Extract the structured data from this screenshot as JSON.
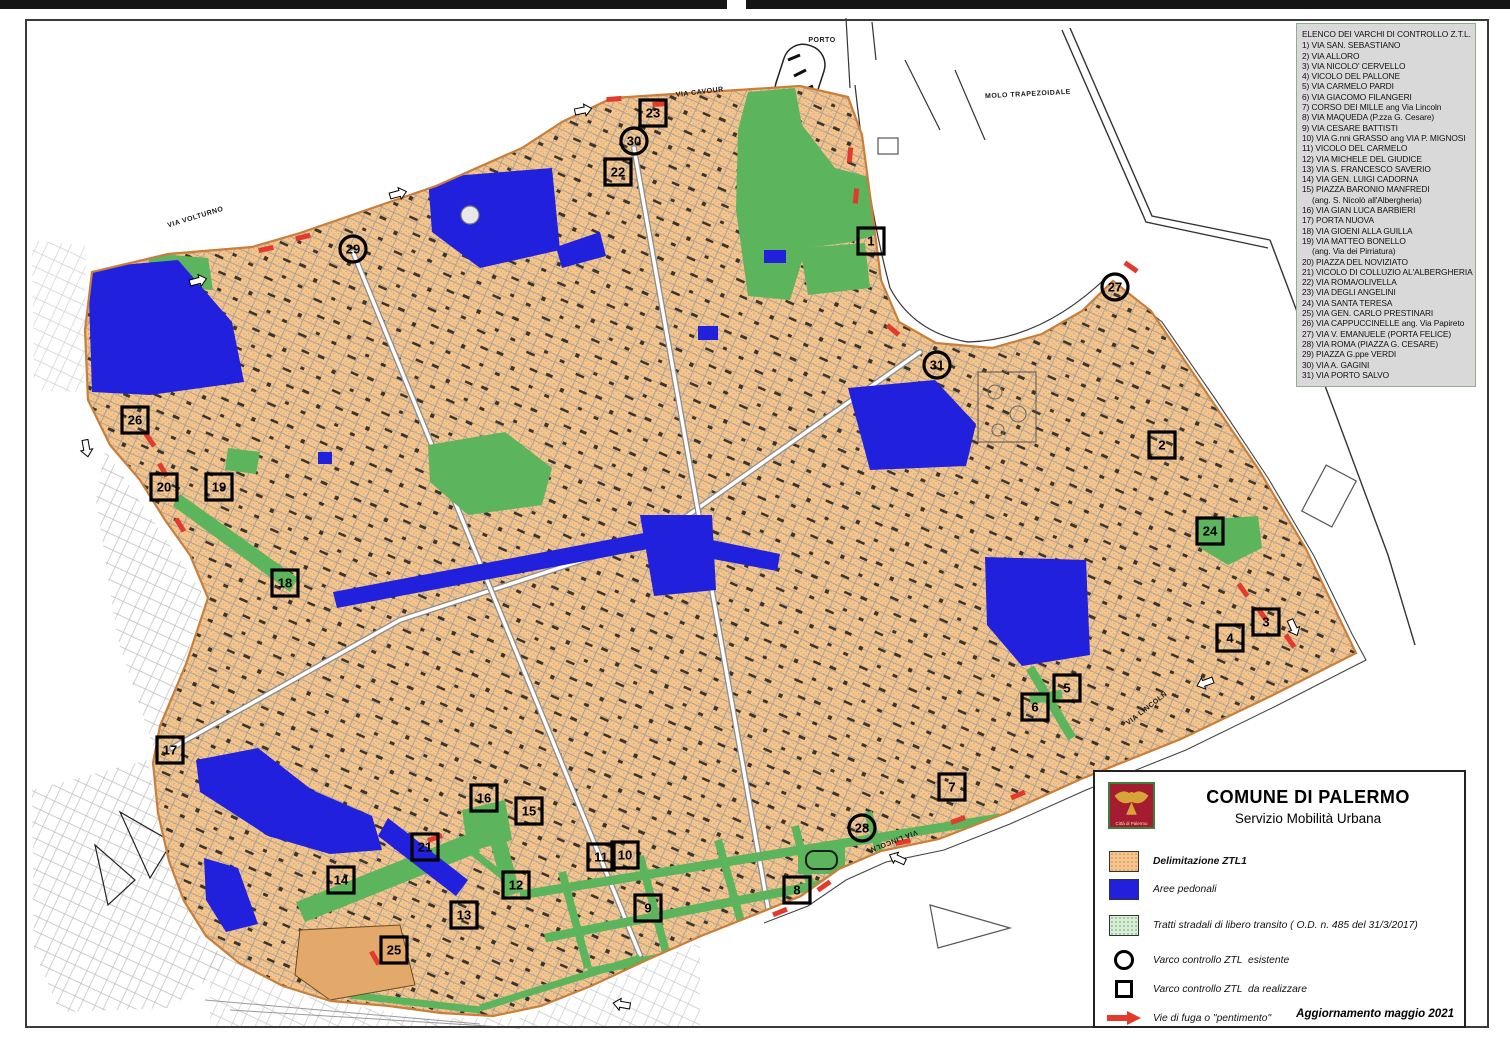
{
  "colors": {
    "ztl_tan": "#f3c58f",
    "pedonale_blue": "#2121dd",
    "transit_green": "#5cb45c",
    "legend_green": "#d8ecd8",
    "red": "#e23b2e",
    "boundary_orange": "#c87f3c",
    "elenco_bg": "#d9d9d9"
  },
  "elenco": {
    "title": "ELENCO DEI VARCHI DI CONTROLLO Z.T.L.",
    "lines": [
      {
        "t": "1) VIA SAN. SEBASTIANO"
      },
      {
        "t": "2) VIA ALLORO"
      },
      {
        "t": "3) VIA NICOLO' CERVELLO"
      },
      {
        "t": "4) VICOLO DEL PALLONE"
      },
      {
        "t": "5) VIA CARMELO PARDI"
      },
      {
        "t": "6) VIA GIACOMO FILANGERI"
      },
      {
        "t": "7) CORSO DEI MILLE ang Via Lincoln"
      },
      {
        "t": "8) VIA MAQUEDA (P.zza G. Cesare)"
      },
      {
        "t": "9) VIA CESARE BATTISTI"
      },
      {
        "t": "10) VIA G.nni GRASSO ang VIA P. MIGNOSI"
      },
      {
        "t": "11) VICOLO DEL CARMELO"
      },
      {
        "t": "12) VIA MICHELE DEL GIUDICE"
      },
      {
        "t": "13) VIA S. FRANCESCO SAVERIO"
      },
      {
        "t": "14) VIA GEN. LUIGI CADORNA"
      },
      {
        "t": "15) PIAZZA BARONIO MANFREDI"
      },
      {
        "t": "(ang. S. Nicolò all'Albergheria)",
        "indent": true
      },
      {
        "t": "16) VIA GIAN LUCA BARBIERI"
      },
      {
        "t": "17) PORTA NUOVA"
      },
      {
        "t": "18) VIA GIOENI ALLA GUILLA"
      },
      {
        "t": "19) VIA MATTEO BONELLO"
      },
      {
        "t": "(ang. Via dei Pirriatura)",
        "indent": true
      },
      {
        "t": "20) PIAZZA DEL NOVIZIATO"
      },
      {
        "t": "21) VICOLO DI COLLUZIO AL'ALBERGHERIA"
      },
      {
        "t": "22) VIA ROMA/OLIVELLA"
      },
      {
        "t": "23) VIA DEGLI ANGELINI"
      },
      {
        "t": "24) VIA SANTA TERESA"
      },
      {
        "t": "25) VIA GEN. CARLO PRESTINARI"
      },
      {
        "t": "26) VIA CAPPUCCINELLE ang. Via Papireto"
      },
      {
        "t": "27) VIA V. EMANUELE (PORTA FELICE)"
      },
      {
        "t": "28) VIA ROMA (PIAZZA G. CESARE)"
      },
      {
        "t": "29) PIAZZA G.ppe VERDI"
      },
      {
        "t": "30) VIA A. GAGINI"
      },
      {
        "t": "31) VIA PORTO SALVO"
      }
    ]
  },
  "legend": {
    "org_title": "COMUNE DI PALERMO",
    "org_subtitle": "Servizio Mobilità Urbana",
    "logo_caption": "Città di Palermo",
    "updated": "Aggiornamento maggio 2021",
    "rows": [
      {
        "type": "ztl",
        "label": "Delimitazione ZTL1",
        "bold": true
      },
      {
        "type": "blue",
        "label": "Aree pedonali"
      },
      {
        "type": "green",
        "label": "Tratti stradali di libero transito ( O.D. n. 485 del 31/3/2017)"
      },
      {
        "type": "circle",
        "label": "Varco controllo ZTL  esistente"
      },
      {
        "type": "square",
        "label": "Varco controllo ZTL  da realizzare"
      },
      {
        "type": "arrow",
        "label": "Vie di fuga o \"pentimento\""
      }
    ]
  },
  "map": {
    "street_labels": [
      {
        "text": "VIA VOLTURNO",
        "x": 196,
        "y": 219,
        "angle": -17
      },
      {
        "text": "VIA CAVOUR",
        "x": 700,
        "y": 94,
        "angle": -7
      },
      {
        "text": "PORTO",
        "x": 822,
        "y": 42,
        "angle": 0
      },
      {
        "text": "MOLO TRAPEZOIDALE",
        "x": 1028,
        "y": 96,
        "angle": -3
      },
      {
        "text": "VIA LINCOLN",
        "x": 1148,
        "y": 710,
        "angle": -38
      },
      {
        "text": "VIA LINCOLN",
        "x": 893,
        "y": 839,
        "angle": 159
      }
    ],
    "markers": [
      {
        "n": 1,
        "shape": "square",
        "x": 871,
        "y": 241
      },
      {
        "n": 2,
        "shape": "square",
        "x": 1162,
        "y": 445
      },
      {
        "n": 3,
        "shape": "square",
        "x": 1266,
        "y": 622
      },
      {
        "n": 4,
        "shape": "square",
        "x": 1230,
        "y": 638
      },
      {
        "n": 5,
        "shape": "square",
        "x": 1067,
        "y": 688
      },
      {
        "n": 6,
        "shape": "square",
        "x": 1035,
        "y": 707
      },
      {
        "n": 7,
        "shape": "square",
        "x": 952,
        "y": 787
      },
      {
        "n": 8,
        "shape": "square",
        "x": 797,
        "y": 890
      },
      {
        "n": 9,
        "shape": "square",
        "x": 648,
        "y": 908
      },
      {
        "n": 10,
        "shape": "square",
        "x": 625,
        "y": 855
      },
      {
        "n": 11,
        "shape": "square",
        "x": 601,
        "y": 857
      },
      {
        "n": 12,
        "shape": "square",
        "x": 516,
        "y": 885
      },
      {
        "n": 13,
        "shape": "square",
        "x": 464,
        "y": 915
      },
      {
        "n": 14,
        "shape": "square",
        "x": 341,
        "y": 880
      },
      {
        "n": 15,
        "shape": "square",
        "x": 529,
        "y": 811
      },
      {
        "n": 16,
        "shape": "square",
        "x": 484,
        "y": 798
      },
      {
        "n": 17,
        "shape": "square",
        "x": 170,
        "y": 750
      },
      {
        "n": 18,
        "shape": "square",
        "x": 285,
        "y": 583
      },
      {
        "n": 19,
        "shape": "square",
        "x": 219,
        "y": 487
      },
      {
        "n": 20,
        "shape": "square",
        "x": 164,
        "y": 487
      },
      {
        "n": 21,
        "shape": "square",
        "x": 425,
        "y": 847
      },
      {
        "n": 22,
        "shape": "square",
        "x": 618,
        "y": 172
      },
      {
        "n": 23,
        "shape": "square",
        "x": 653,
        "y": 113
      },
      {
        "n": 24,
        "shape": "square",
        "x": 1210,
        "y": 531
      },
      {
        "n": 25,
        "shape": "square",
        "x": 394,
        "y": 950
      },
      {
        "n": 26,
        "shape": "square",
        "x": 135,
        "y": 420
      },
      {
        "n": 27,
        "shape": "circle",
        "x": 1115,
        "y": 287
      },
      {
        "n": 28,
        "shape": "circle",
        "x": 862,
        "y": 828
      },
      {
        "n": 29,
        "shape": "circle",
        "x": 353,
        "y": 249
      },
      {
        "n": 30,
        "shape": "circle",
        "x": 634,
        "y": 141
      },
      {
        "n": 31,
        "shape": "circle",
        "x": 937,
        "y": 365
      }
    ]
  }
}
